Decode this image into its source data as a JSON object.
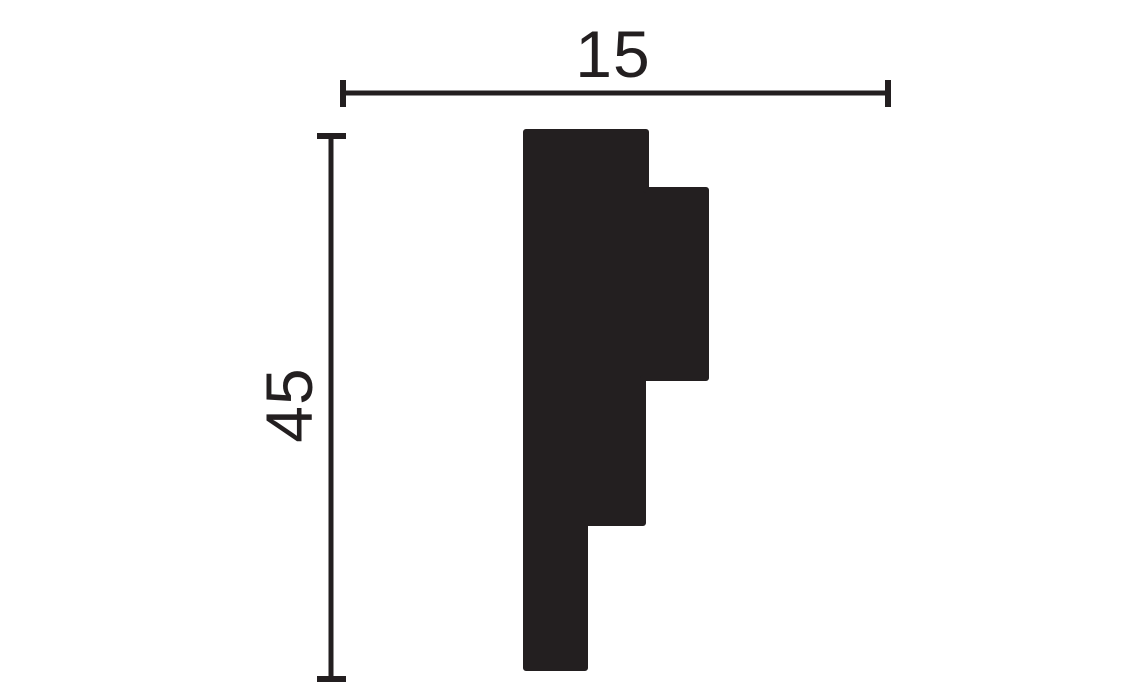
{
  "page": {
    "background_color": "#ffffff",
    "ink_color": "#231f20",
    "description": "Technical cross-section drawing of a stepped moulding profile with width and height dimension lines"
  },
  "dimensions": {
    "width": {
      "label": "15",
      "line": {
        "x1": 343,
        "y1": 93,
        "x2": 888,
        "y2": 93
      },
      "tick_start": {
        "x1": 343,
        "y1": 80,
        "x2": 343,
        "y2": 107
      },
      "tick_end": {
        "x1": 888,
        "y1": 80,
        "x2": 888,
        "y2": 107
      }
    },
    "height": {
      "label": "45",
      "line": {
        "x1": 331,
        "y1": 136,
        "x2": 331,
        "y2": 679
      },
      "tick_start": {
        "x1": 317,
        "y1": 136,
        "x2": 346,
        "y2": 136
      },
      "tick_end": {
        "x1": 317,
        "y1": 679,
        "x2": 346,
        "y2": 679
      }
    }
  },
  "profile": {
    "points": "526,132 646,132 646,190 706,190 706,378 643,378 643,523 585,523 585,668 526,668",
    "fill": "#231f20"
  }
}
